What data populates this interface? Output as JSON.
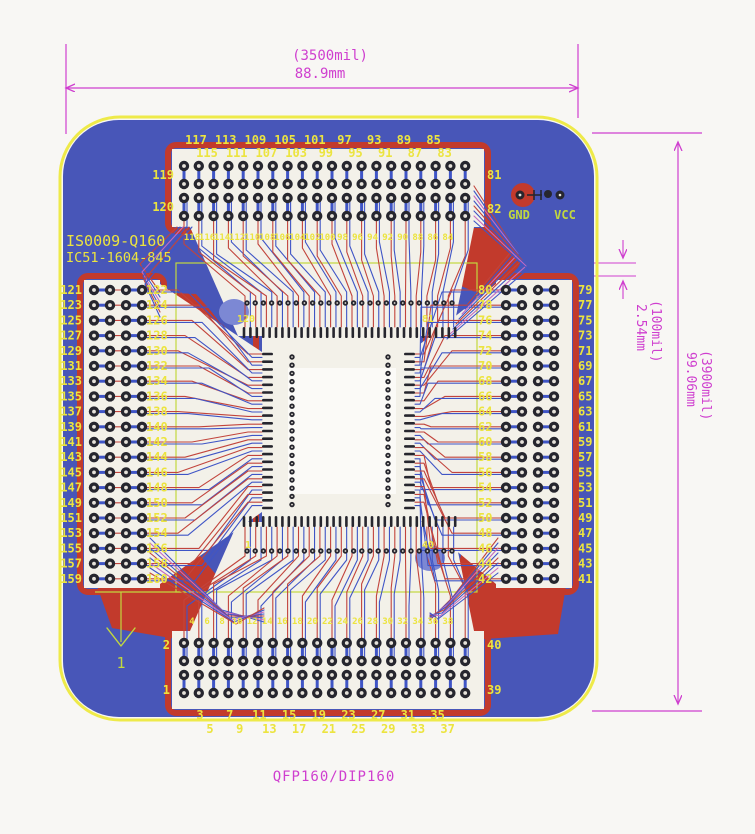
{
  "title": "QFP160/DIP160",
  "dimensions": {
    "width": {
      "mil": "(3500mil)",
      "mm": "88.9mm"
    },
    "height": {
      "mil": "(3900mil)",
      "mm": "99.06mm"
    },
    "pitch": {
      "mil": "(100mil)",
      "mm": "2.54mm"
    }
  },
  "silkscreen": {
    "board_id": "IS0009-Q160",
    "socket_id": "IC51-1604-845",
    "pin1_marker": "1",
    "power_labels": {
      "gnd": "GND",
      "vcc": "VCC"
    }
  },
  "pin_labels": {
    "top": {
      "left": [
        "119",
        "120"
      ],
      "right": [
        "81",
        "82"
      ],
      "row_upper": [
        "117",
        "113",
        "109",
        "105",
        "101",
        "97",
        "93",
        "89",
        "85"
      ],
      "row_lower": [
        "115",
        "111",
        "107",
        "103",
        "99",
        "95",
        "91",
        "87",
        "83"
      ],
      "inner_row": [
        "118",
        "116",
        "114",
        "112",
        "110",
        "108",
        "106",
        "104",
        "102",
        "100",
        "98",
        "96",
        "94",
        "92",
        "90",
        "88",
        "86",
        "84"
      ]
    },
    "bottom": {
      "left": [
        "2",
        "1"
      ],
      "right": [
        "40",
        "39"
      ],
      "row_upper": [
        "3",
        "7",
        "11",
        "15",
        "19",
        "23",
        "27",
        "31",
        "35"
      ],
      "row_lower": [
        "5",
        "9",
        "13",
        "17",
        "21",
        "25",
        "29",
        "33",
        "37"
      ],
      "inner_row": [
        "4",
        "6",
        "8",
        "10",
        "12",
        "14",
        "16",
        "18",
        "20",
        "22",
        "24",
        "26",
        "28",
        "30",
        "32",
        "34",
        "36",
        "38"
      ]
    },
    "left": {
      "outer": [
        "121",
        "123",
        "125",
        "127",
        "129",
        "131",
        "133",
        "135",
        "137",
        "139",
        "141",
        "143",
        "145",
        "147",
        "149",
        "151",
        "153",
        "155",
        "157",
        "159"
      ],
      "inner": [
        "122",
        "124",
        "126",
        "128",
        "130",
        "132",
        "134",
        "136",
        "138",
        "140",
        "142",
        "144",
        "146",
        "148",
        "150",
        "152",
        "154",
        "156",
        "158",
        "160"
      ]
    },
    "right": {
      "outer": [
        "80",
        "78",
        "76",
        "74",
        "72",
        "70",
        "68",
        "66",
        "64",
        "62",
        "60",
        "58",
        "56",
        "54",
        "52",
        "50",
        "48",
        "46",
        "44",
        "42"
      ],
      "inner": [
        "79",
        "77",
        "75",
        "73",
        "71",
        "69",
        "67",
        "65",
        "63",
        "61",
        "59",
        "57",
        "55",
        "53",
        "51",
        "49",
        "47",
        "45",
        "43",
        "41"
      ]
    },
    "qfp_corners": {
      "tl": "120",
      "tr": "81",
      "bl": "1",
      "br": "40"
    }
  },
  "colors": {
    "dimension_magenta": "#cf3fcf",
    "board_blue": "#4856b8",
    "silkscreen_yellow": "#ece43f",
    "silkscreen_green": "#c2d83e",
    "copper_red": "#c23a2c",
    "trace_red": "#c2443c",
    "trace_blue": "#3f55c6",
    "trace_pink": "#c46ac0",
    "pad_dark": "#26262e",
    "pad_zone_white": "#f3f1e9"
  }
}
